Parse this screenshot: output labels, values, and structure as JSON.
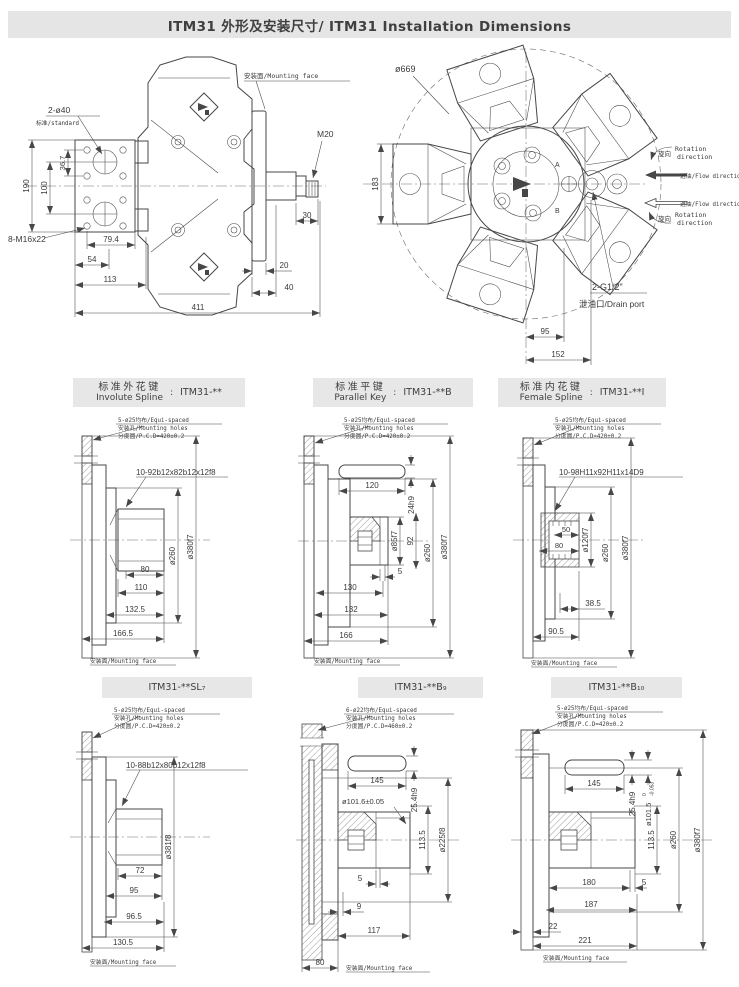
{
  "title": "ITM31 外形及安装尺寸/ ITM31 Installation Dimensions",
  "sep": ":",
  "colors": {
    "band_bg": "#e6e6e6",
    "line": "#474747"
  },
  "side": {
    "mf": "安装面/Mounting face",
    "ports": "2-ø40",
    "std": "标准/standard",
    "bolts": "8-M16x22",
    "m20": "M20",
    "d190": "190",
    "d100": "100",
    "d36": "36.7",
    "d79": "79.4",
    "d54": "54",
    "d113": "113",
    "d411": "411",
    "d30": "30",
    "d20": "20",
    "d40": "40"
  },
  "front": {
    "d669": "ø669",
    "d183": "183",
    "d95": "95",
    "d152": "152",
    "a": "A",
    "b": "B",
    "drain": "2-G1/2\"",
    "drain_l": "泄油口/Drain port",
    "rot": "旋向",
    "rot1": "Rotation",
    "rot2": "direction",
    "flow": "进油/Flow direction"
  },
  "p_ml": {
    "zh": "标准外花键",
    "en": "Involute Spline",
    "code": "ITM31-**",
    "n1": "5-ø25均布/Equi-spaced",
    "n2": "安装孔/Mounting holes",
    "n3": "分度圆/P.C.D=420±0.2",
    "callout": "10-92b12x82b12x12f8",
    "d260": "ø260",
    "d380": "ø380f7",
    "d80": "80",
    "d110": "110",
    "d132": "132.5",
    "d166": "166.5",
    "mf": "安装面/Mounting face"
  },
  "p_mc": {
    "zh": "标准平键",
    "en": "Parallel Key",
    "code": "ITM31-**B",
    "n1": "5-ø25均布/Equi-spaced",
    "n2": "安装孔/Mounting holes",
    "n3": "分度圆/P.C.D=420±0.2",
    "d120": "120",
    "k24": "24h9",
    "d85": "ø85f7",
    "d92": "92",
    "d260": "ø260",
    "d380": "ø380f7",
    "d5": "5",
    "d130": "130",
    "d132": "132",
    "d166": "166",
    "mf": "安装面/Mounting face"
  },
  "p_mr": {
    "zh": "标准内花键",
    "en": "Female Spline",
    "code": "ITM31-**I",
    "n1": "5-ø25均布/Equi-spaced",
    "n2": "安装孔/Mounting holes",
    "n3": "分度圆/P.C.D=420±0.2",
    "callout": "10-98H11x92H11x14D9",
    "d50": "50",
    "d80": "80",
    "d120": "ø120f7",
    "d260": "ø260",
    "d380": "ø380f7",
    "d38": "38.5",
    "d90": "90.5",
    "mf": "安装面/Mounting face"
  },
  "p_bl": {
    "code": "ITM31-**SL₇",
    "n1": "5-ø25均布/Equi-spaced",
    "n2": "安装孔/Mounting holes",
    "n3": "分度圆/P.C.D=420±0.2",
    "callout": "10-88b12x80b12x12f8",
    "d381": "ø381f8",
    "d72": "72",
    "d95": "95",
    "d96": "96.5",
    "d130": "130.5",
    "mf": "安装面/Mounting face"
  },
  "p_bc": {
    "code": "ITM31-**B₉",
    "n1": "6-ø22均布/Equi-spaced",
    "n2": "安装孔/Mounting holes",
    "n3": "分度圆/P.C.D=460±0.2",
    "d145": "145",
    "k25": "25.4h9",
    "d101": "ø101.6±0.05",
    "d113": "113.5",
    "d225": "ø225f8",
    "d5": "5",
    "d9": "9",
    "d117": "117",
    "d80": "80",
    "mf": "安装面/Mounting face"
  },
  "p_br": {
    "code": "ITM31-**B₁₀",
    "n1": "5-ø25均布/Equi-spaced",
    "n2": "安装孔/Mounting holes",
    "n3": "分度圆/P.C.D=420±0.2",
    "d145": "145",
    "k25": "25.4h9",
    "d101": "ø101.5",
    "tol0": "0",
    "toln": "-0.053",
    "d113": "113.5",
    "d260": "ø260",
    "d380": "ø380f7",
    "d180": "180",
    "d5": "5",
    "d187": "187",
    "d22": "22",
    "d221": "221",
    "mf": "安装面/Mounting face"
  }
}
